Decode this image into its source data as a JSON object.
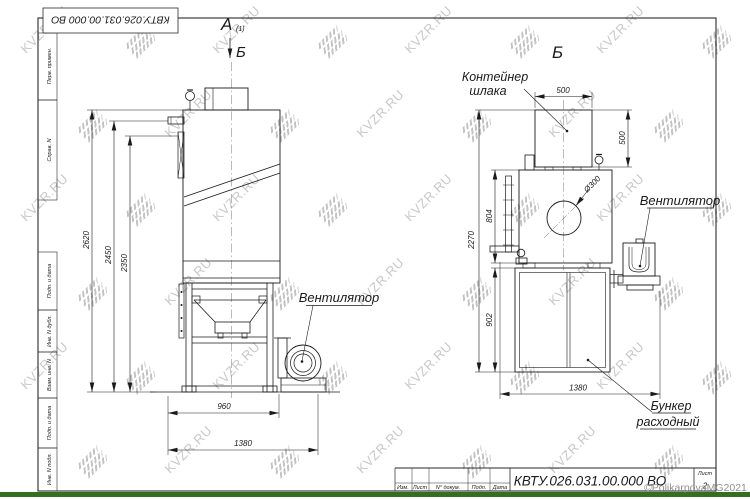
{
  "watermark": {
    "text": "KVZR.RU",
    "copyright": "©PolikarpovaMG2021"
  },
  "frame": {
    "doc_number": "КВТУ.026.031.00.000  ВО",
    "sidebar": [
      "Перв. примен.",
      "Справ. N",
      "Подп. и дата",
      "Инв. N дубл.",
      "Взам. инв. N",
      "Подп. и дата",
      "Инв. N подл."
    ],
    "title_block": {
      "columns": [
        "Изм.",
        "Лист",
        "N° докум.",
        "Подп.",
        "Дата"
      ],
      "sheet_label": "Лист",
      "sheet_number": "2"
    }
  },
  "views": {
    "left": {
      "view_label_a": "А",
      "view_label_a_sub": "(1)",
      "view_label_b": "Б",
      "fan_label": "Вентилятор",
      "dims": {
        "height_total": "2620",
        "height_pipe": "2450",
        "height_door": "2350",
        "width_frame": "960",
        "width_total": "1380"
      }
    },
    "right": {
      "view_label": "Б",
      "container_label_1": "Контейнер",
      "container_label_2": "шлака",
      "fan_label": "Вентилятор",
      "bunker_label_1": "Бункер",
      "bunker_label_2": "расходный",
      "dims": {
        "container_w": "500",
        "container_h": "500",
        "body_h": "804",
        "bunker_h": "902",
        "height_total": "2270",
        "width_total": "1380",
        "diameter": "Ø300"
      }
    }
  }
}
